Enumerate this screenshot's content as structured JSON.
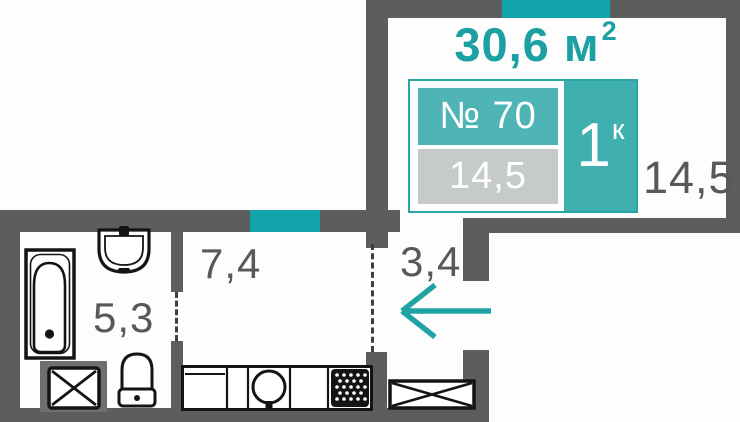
{
  "plan": {
    "title": "apartment-floor-plan",
    "total_area": {
      "value": "30,6",
      "unit": "м",
      "unit_sup": "2"
    },
    "unit_badge": {
      "number": "№ 70",
      "area": "14,5",
      "rooms": "1",
      "rooms_sup": "к"
    },
    "room_labels": {
      "living_room": "14,5",
      "bathroom": "5,3",
      "kitchen": "7,4",
      "hallway": "3,4"
    },
    "fixtures": [
      "bathtub-icon",
      "sink-icon",
      "toilet-icon",
      "washing-machine-icon",
      "kitchen-counter-icon",
      "stove-icon",
      "wardrobe-icon",
      "entrance-arrow-icon",
      "window-segment",
      "window-segment"
    ],
    "colors": {
      "wall": "#5d5d5d",
      "accent_teal": "#21a3a5",
      "window_teal": "#12a4ad",
      "badge_fill_teal": "#4fb4b5",
      "badge_fill_gray": "#c7cacb",
      "label_gray": "#57585a",
      "fixture_line": "#141414"
    }
  }
}
